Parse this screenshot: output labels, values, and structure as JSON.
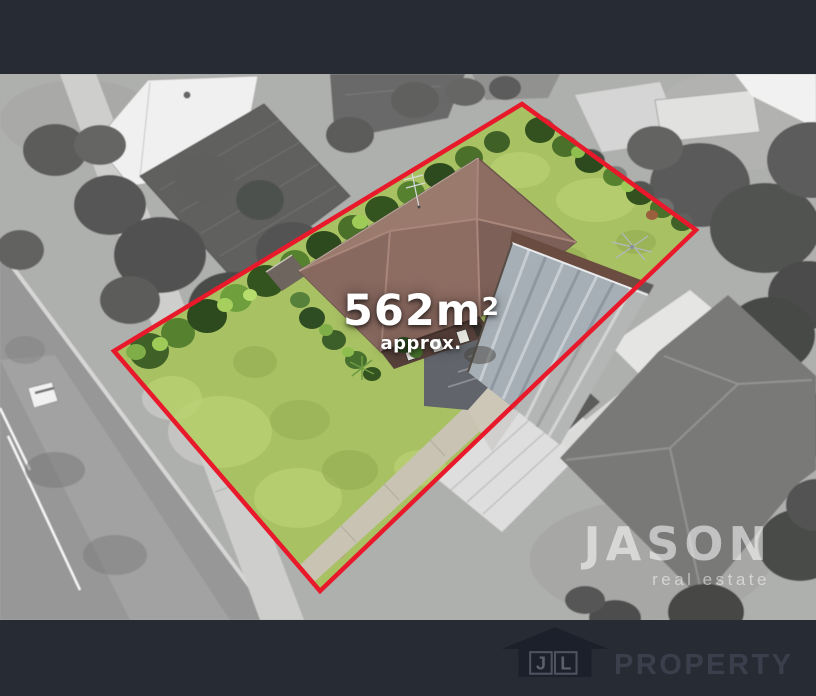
{
  "overlay": {
    "area_value": "562m",
    "area_exponent": "2",
    "area_qualifier": "approx.",
    "agency_name": "JASON",
    "agency_tagline": "real estate"
  },
  "footer_logo": {
    "monogram_left": "J",
    "monogram_right": "L",
    "brand": "PROPERTY"
  },
  "colors": {
    "boundary_red": "#e8192b",
    "letterbox_bar": "#262b34",
    "area_text": "#ffffff",
    "watermark_text": "#ffffff",
    "footer_logo_dark": "#1b202a",
    "footer_monogram_box": "#4d5460",
    "footer_brand_text": "#39404c",
    "lawn_green": "#a8c163",
    "roof_brown": "#8d6c62"
  }
}
